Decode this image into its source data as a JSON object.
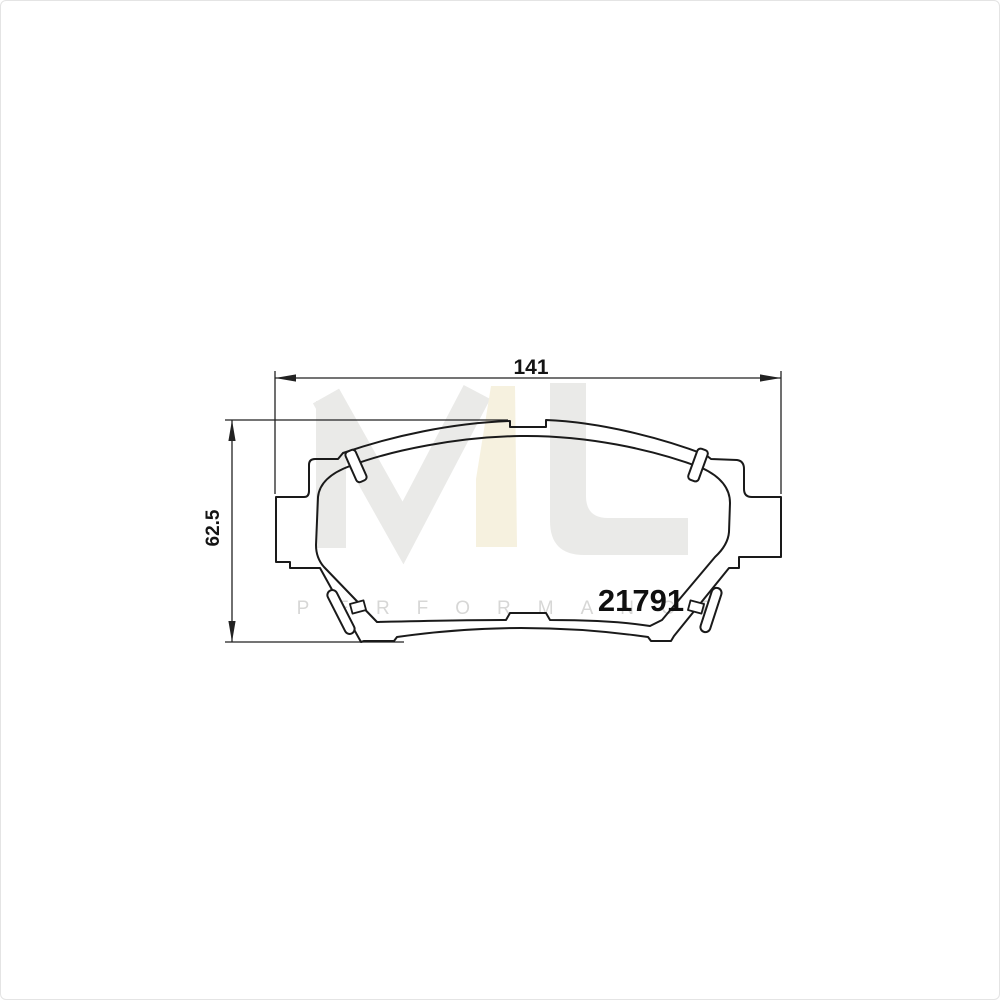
{
  "drawing": {
    "kind": "brake-pad technical drawing",
    "part_number": "21791",
    "width_label": "141",
    "height_label": "62.5",
    "line_color": "#1a1a1a",
    "dimension_color": "#222222"
  },
  "watermark": {
    "monogram": "ML",
    "subtitle": "PERFORMANCE",
    "gray": "#eaeae8",
    "cream": "#f6f1df",
    "subtitle_color": "#d7d7d6"
  }
}
